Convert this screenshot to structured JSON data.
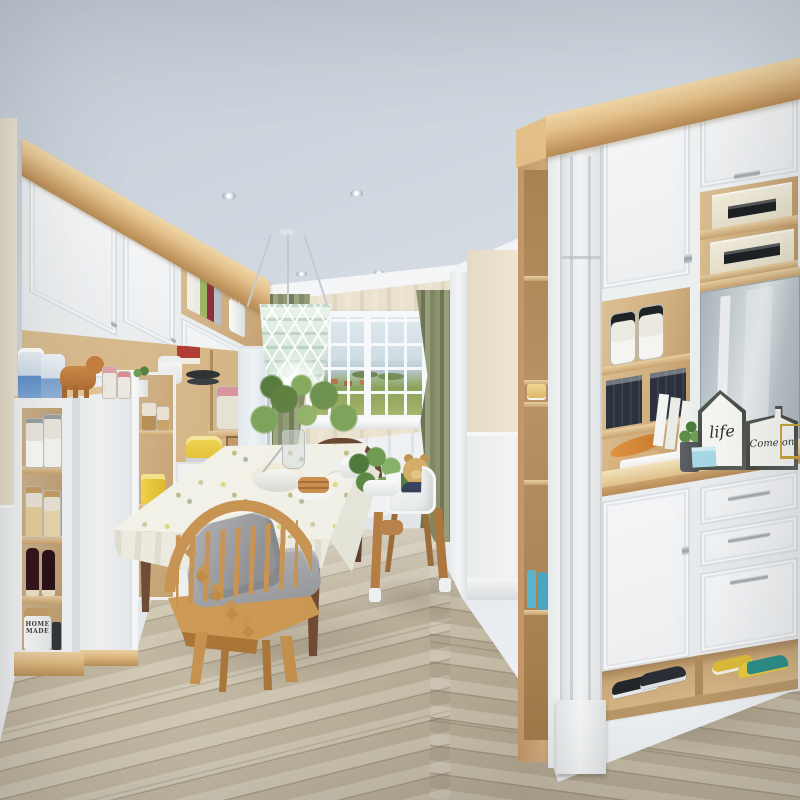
{
  "meta": {
    "type": "interior-photograph",
    "room": "dining room with built-in white cabinetry, mudroom unit and wood-look floor",
    "image_size": "800x800"
  },
  "texts": {
    "house_sign": "life",
    "board_sign": "Come on",
    "canister": "HOME MADE"
  },
  "palette": {
    "ceiling": "#d3dae2",
    "crown_wood": "#ddb87f",
    "cabinet_white": "#f2f3f4",
    "shelf_wood": "#d8ba8e",
    "wallpaper": "#e7decb",
    "wainscot": "#eef0f1",
    "curtain_olive": "#8d9471",
    "window_sky": "#d7e2e8",
    "window_field": "#8fa25a",
    "floor_plank": "#c0b59e",
    "chair_oak": "#c89454",
    "table_walnut": "#6e4a33",
    "cushion_gray": "#a7a9ac",
    "lamp_mint": "#d8e8db",
    "teddy_tan": "#c9a25f",
    "binder_dark": "#2d3440",
    "toaster_yellow": "#e9ca3e",
    "boots_blue": "#5cb6cd",
    "shoe_teal": "#2b8d8a",
    "shoe_yellow": "#ddba39",
    "wine_bottle": "#33131a"
  },
  "scene": {
    "ceiling": {
      "recessed_lights": 4,
      "pendant": "mint woven drum pendant"
    },
    "left_wall": {
      "structure": "white upper doors, open wood shelving, sliding wardrobe, narrow open tower",
      "items": [
        "glass jars",
        "cookie jars",
        "wine bottles",
        "HOME MADE canister",
        "wipes packs",
        "wooden elephant toy",
        "pink lid jars",
        "potted plant",
        "red box",
        "rice cooker",
        "pans",
        "yellow toaster",
        "yellow canister",
        "black roasting pan",
        "wine rack cubbies",
        "books",
        "white vase"
      ]
    },
    "dining_nook": {
      "window_view": "sky, hills, green fields, small houses",
      "curtains": "olive green, tied back",
      "table": "dark walnut legs, white patterned tablecloth",
      "table_items": [
        "white bowl with whisk",
        "pancake stack",
        "plates",
        "teapot",
        "leafy plant in glass vase"
      ],
      "chairs": [
        "light oak spindle chair with gray cushion and pillow",
        "dark walnut spindle chair",
        "white high chair with teddy bear"
      ]
    },
    "right_unit": {
      "structure": "tall white mudroom cabinet with mirror niche, counter, drawers and open shoe shelf",
      "items": [
        "storage boxes",
        "water bottles",
        "black binders",
        "orange fish decor on board",
        "white tray",
        "succulent in gray pot",
        "house-shaped sign",
        "board-shaped sign",
        "blue note card",
        "gold wire rack",
        "blue rain boots",
        "cake on shelf",
        "sneakers",
        "teal shoes",
        "yellow slipper"
      ]
    }
  }
}
